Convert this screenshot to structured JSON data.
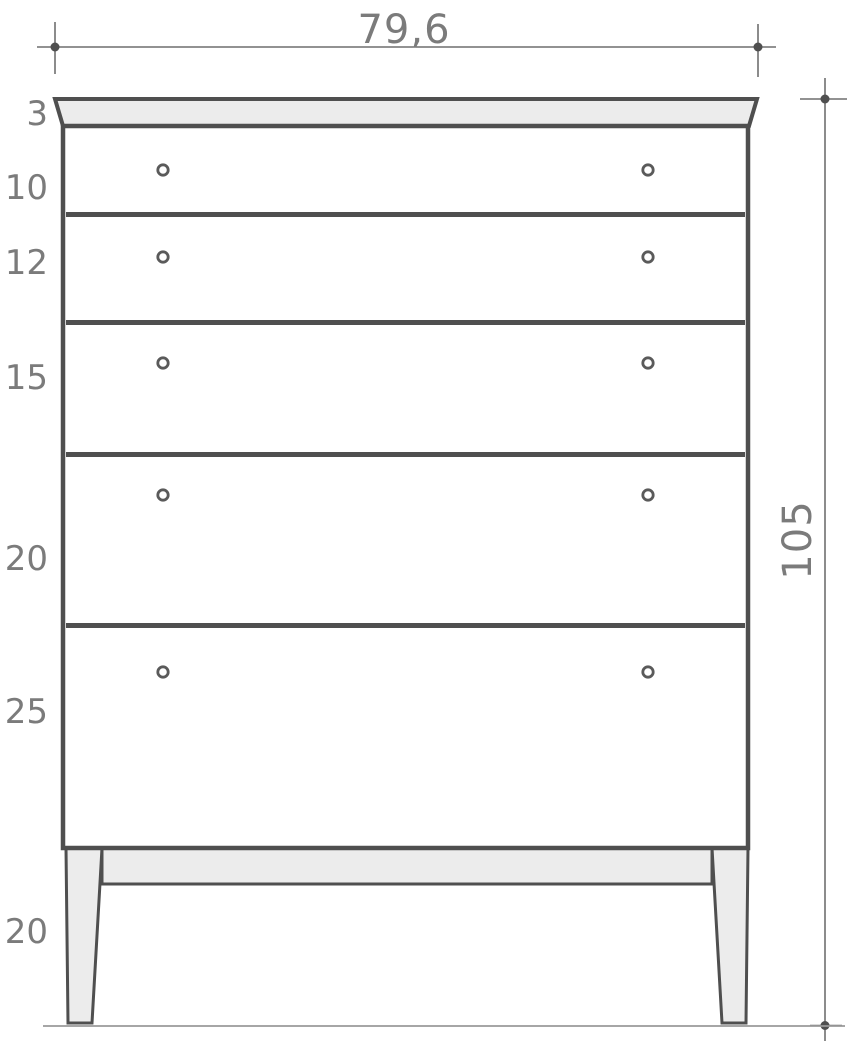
{
  "figure": {
    "subject": "chest-of-drawers-technical-drawing",
    "drawer_count": 5,
    "knobs_per_drawer": 2
  },
  "dimensions": {
    "overall_width": "79,6",
    "overall_height": "105",
    "top_panel_thickness": "3",
    "drawer_heights": [
      "10",
      "12",
      "15",
      "20",
      "25"
    ],
    "leg_height": "20"
  },
  "icons": {
    "dimension_endpoint": "filled-dot-with-crosshair",
    "drawer_knob": "ring-circle"
  },
  "colors": {
    "background": "#ffffff",
    "outline": "#4f4f4f",
    "dimension_line": "#6f6f6f",
    "ground_line": "#9a9a9a",
    "label_text": "#7b7b7b",
    "panel_fill": "#ececec",
    "drawer_fill": "#ffffff",
    "knob": "#5a5a5a"
  }
}
